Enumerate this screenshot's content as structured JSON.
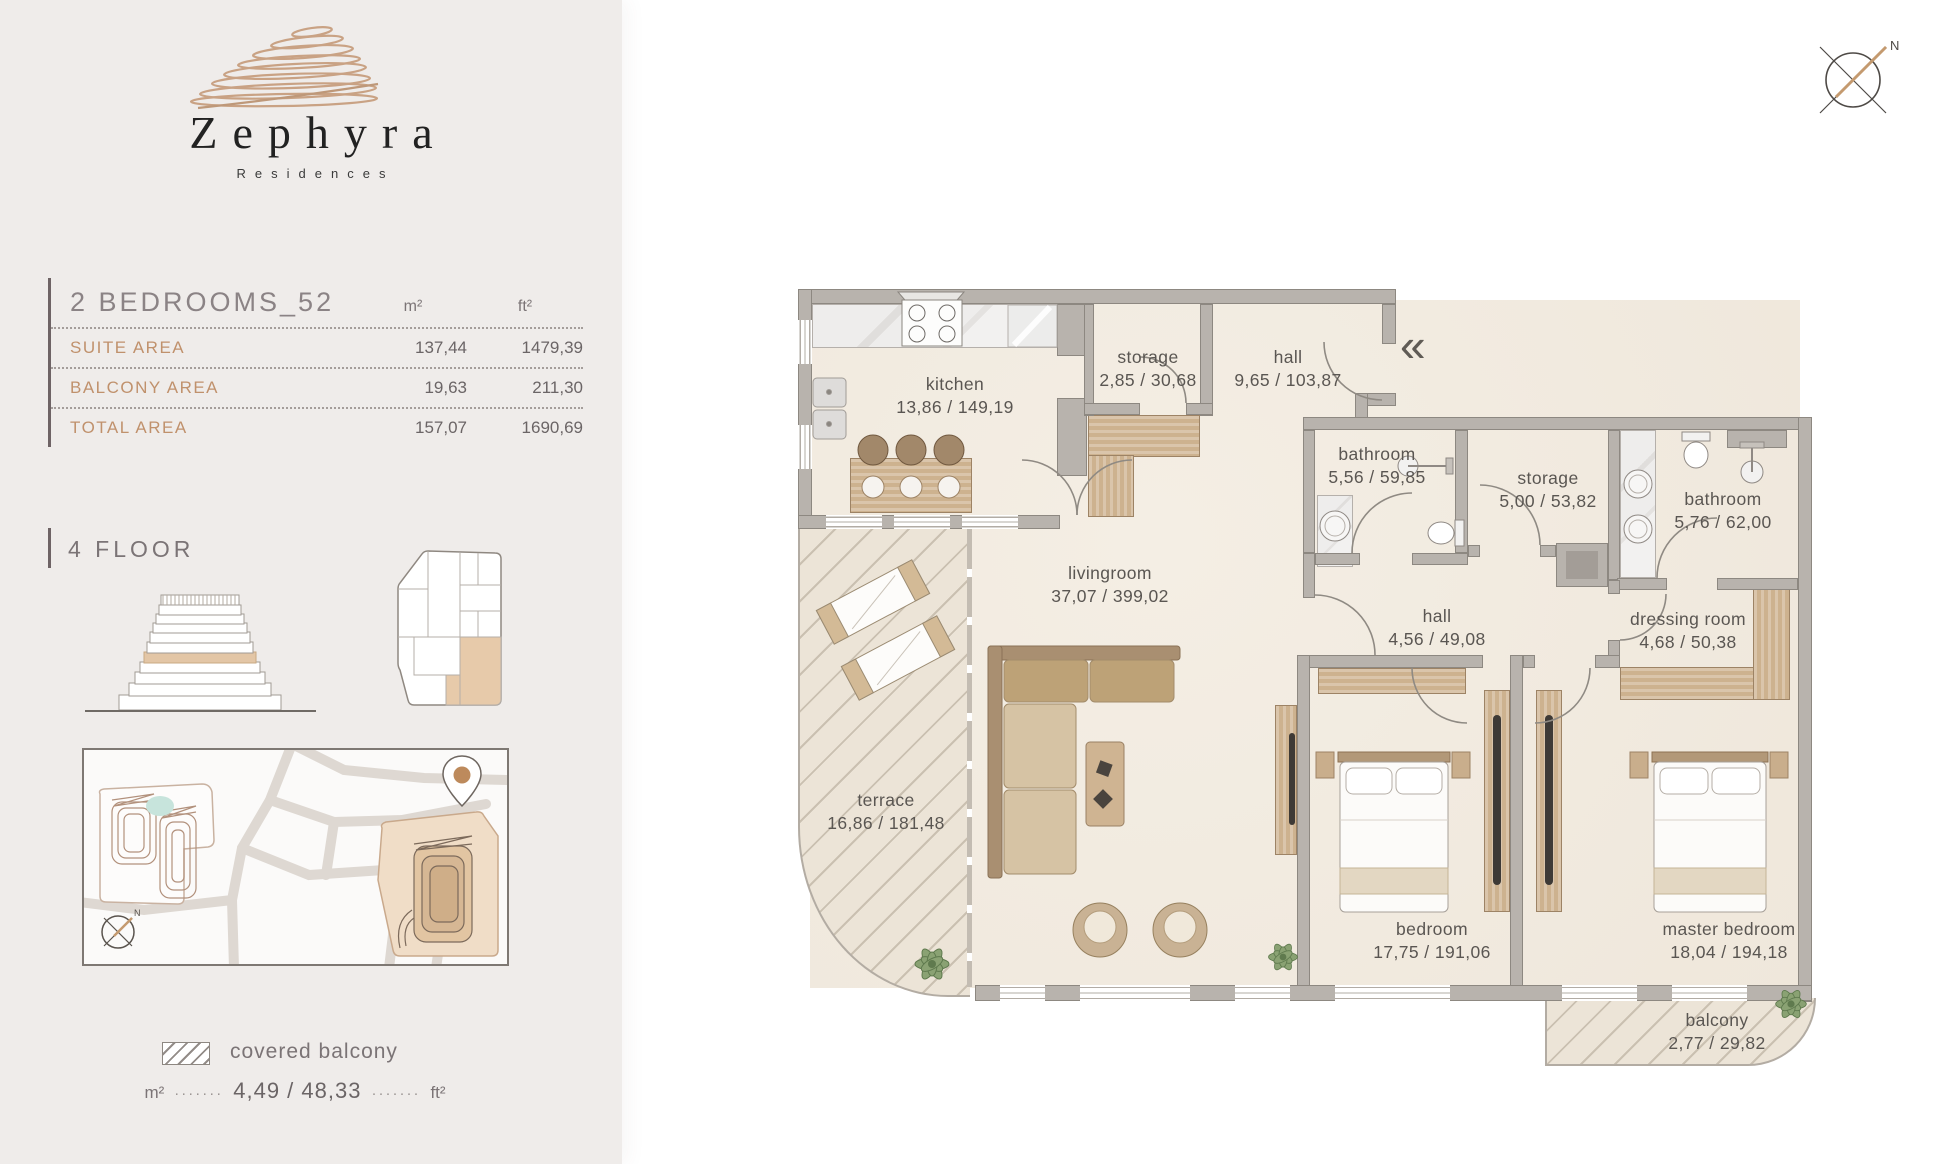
{
  "brand": {
    "name": "Zephyra",
    "subtitle": "Residences"
  },
  "unit": {
    "title": "2 BEDROOMS_52",
    "columns": {
      "m2": "m²",
      "ft2": "ft²"
    },
    "rows": [
      {
        "label": "SUITE AREA",
        "m2": "137,44",
        "ft2": "1479,39"
      },
      {
        "label": "BALCONY AREA",
        "m2": "19,63",
        "ft2": "211,30"
      },
      {
        "label": "TOTAL AREA",
        "m2": "157,07",
        "ft2": "1690,69"
      }
    ]
  },
  "floor": {
    "label": "4 FLOOR"
  },
  "legend": {
    "swatch": "covered balcony",
    "m2": "m²",
    "value": "4,49 / 48,33",
    "ft2": "ft²"
  },
  "compass": {
    "north": "N"
  },
  "map": {
    "north": "N"
  },
  "entry": {
    "symbol": "«"
  },
  "rooms": [
    {
      "name": "kitchen",
      "area": "13,86 / 149,19"
    },
    {
      "name": "storage",
      "area": "2,85 / 30,68"
    },
    {
      "name": "hall",
      "area": "9,65 / 103,87"
    },
    {
      "name": "bathroom",
      "area": "5,56 / 59,85"
    },
    {
      "name": "storage",
      "area": "5,00 / 53,82"
    },
    {
      "name": "bathroom",
      "area": "5,76 / 62,00"
    },
    {
      "name": "livingroom",
      "area": "37,07 / 399,02"
    },
    {
      "name": "hall",
      "area": "4,56 / 49,08"
    },
    {
      "name": "dressing room",
      "area": "4,68 / 50,38"
    },
    {
      "name": "terrace",
      "area": "16,86 / 181,48"
    },
    {
      "name": "bedroom",
      "area": "17,75 / 191,06"
    },
    {
      "name": "master bedroom",
      "area": "18,04 / 194,18"
    },
    {
      "name": "balcony",
      "area": "2,77 / 29,82"
    }
  ],
  "colors": {
    "accent_tan": "#c49a78",
    "highlight": "#e7ceb0",
    "wall": "#b8b3ad",
    "area_label": "#c0916c",
    "value_text": "#6b6566",
    "room_label": "#5a5652"
  }
}
